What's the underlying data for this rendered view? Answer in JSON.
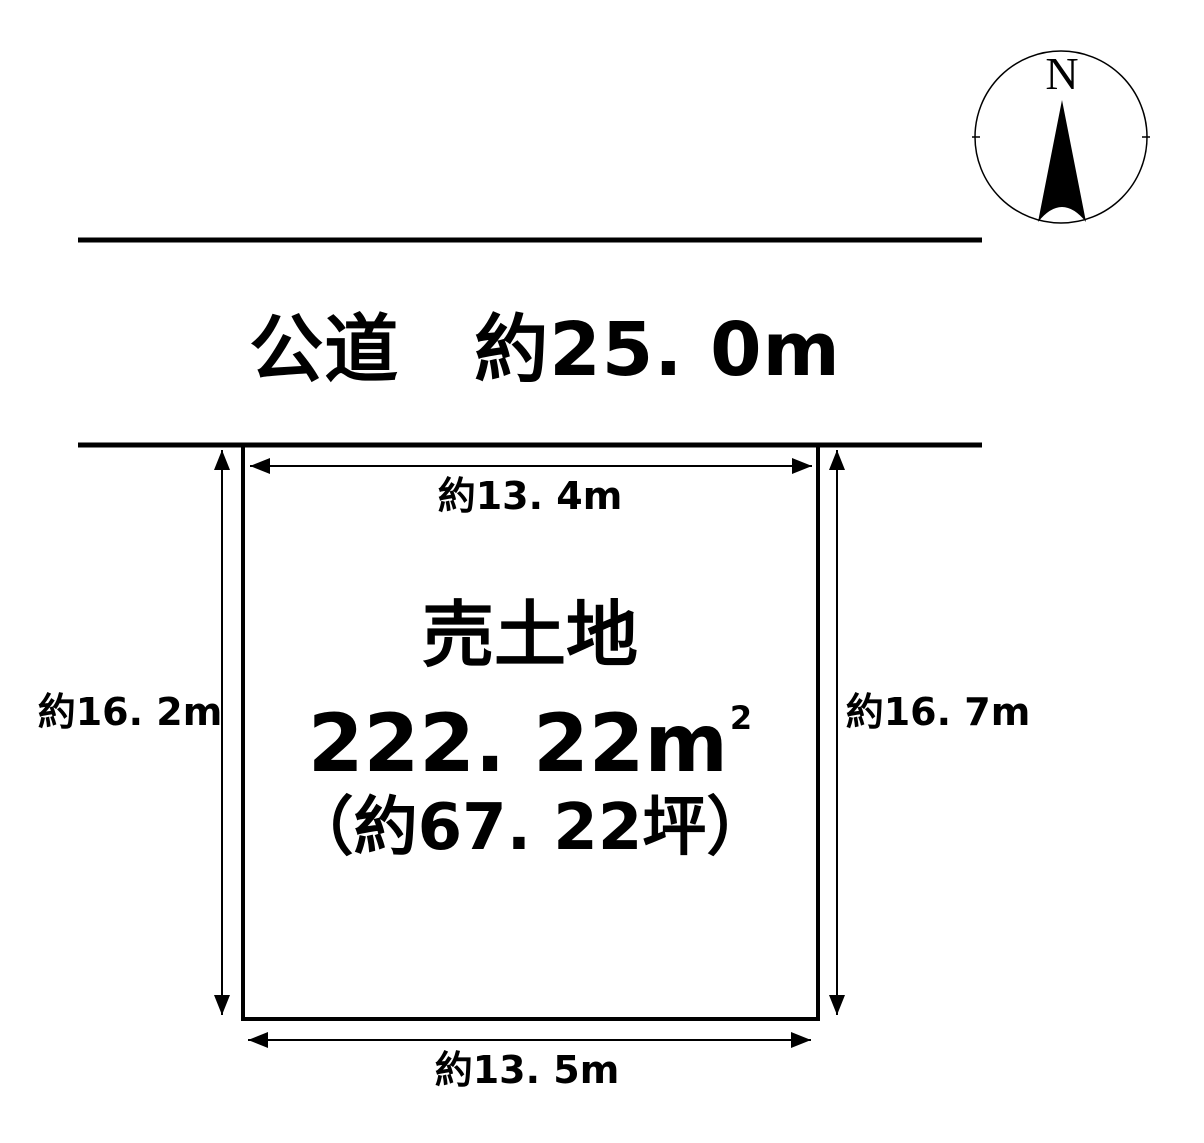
{
  "colors": {
    "background": "#ffffff",
    "ink": "#000000"
  },
  "compass": {
    "north_label": "N"
  },
  "road": {
    "label": "公道　約25. 0m"
  },
  "plot": {
    "title": "売土地",
    "area_main": "222. 22m",
    "area_sup": "2",
    "area_tsubo": "（約67. 22坪）"
  },
  "dimensions": {
    "top": "約13. 4m",
    "bottom": "約13. 5m",
    "left": "約16. 2m",
    "right": "約16. 7m"
  }
}
